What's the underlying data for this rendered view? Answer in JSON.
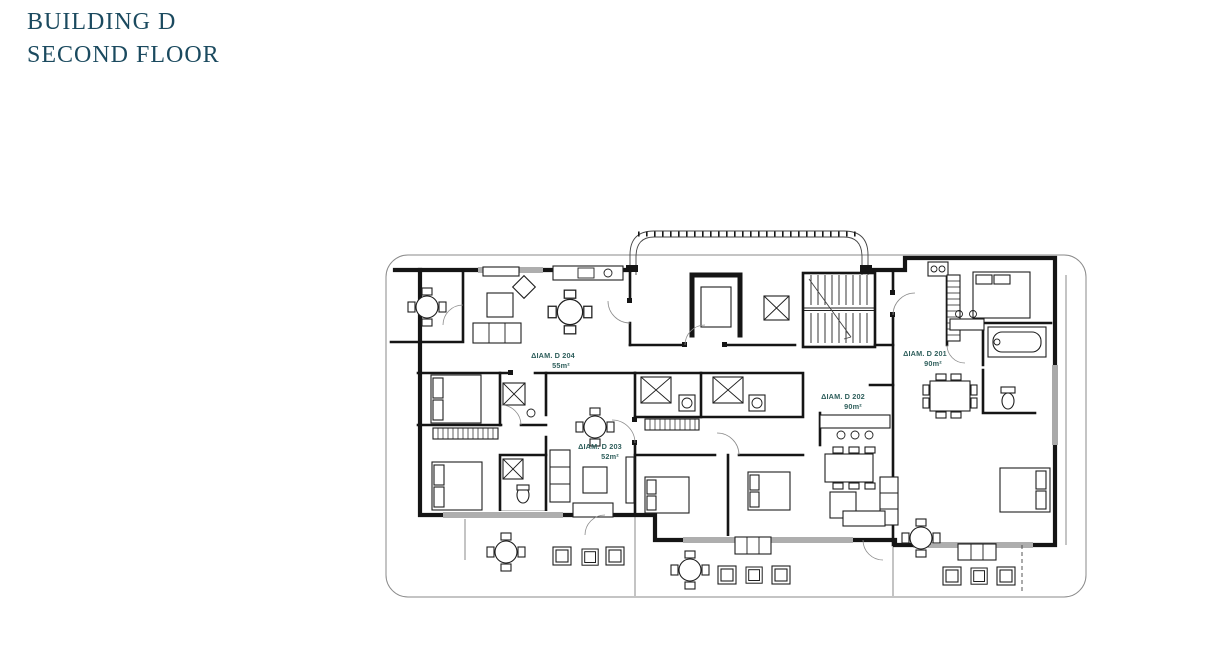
{
  "header": {
    "title_line1": "BUILDING D",
    "title_line2": "SECOND FLOOR"
  },
  "colors": {
    "title": "#1b4a5f",
    "plan_label": "#2f5f5c",
    "plan_line": "#151515"
  },
  "floor_plan": {
    "apartments": [
      {
        "id": "D201",
        "label": "ΔΙΑΜ. D 201",
        "area": "90m²"
      },
      {
        "id": "D202",
        "label": "ΔΙΑΜ. D 202",
        "area": "90m²"
      },
      {
        "id": "D203",
        "label": "ΔΙΑΜ. D 203",
        "area": "52m²"
      },
      {
        "id": "D204",
        "label": "ΔΙΑΜ. D 204",
        "area": "55m²"
      }
    ]
  }
}
